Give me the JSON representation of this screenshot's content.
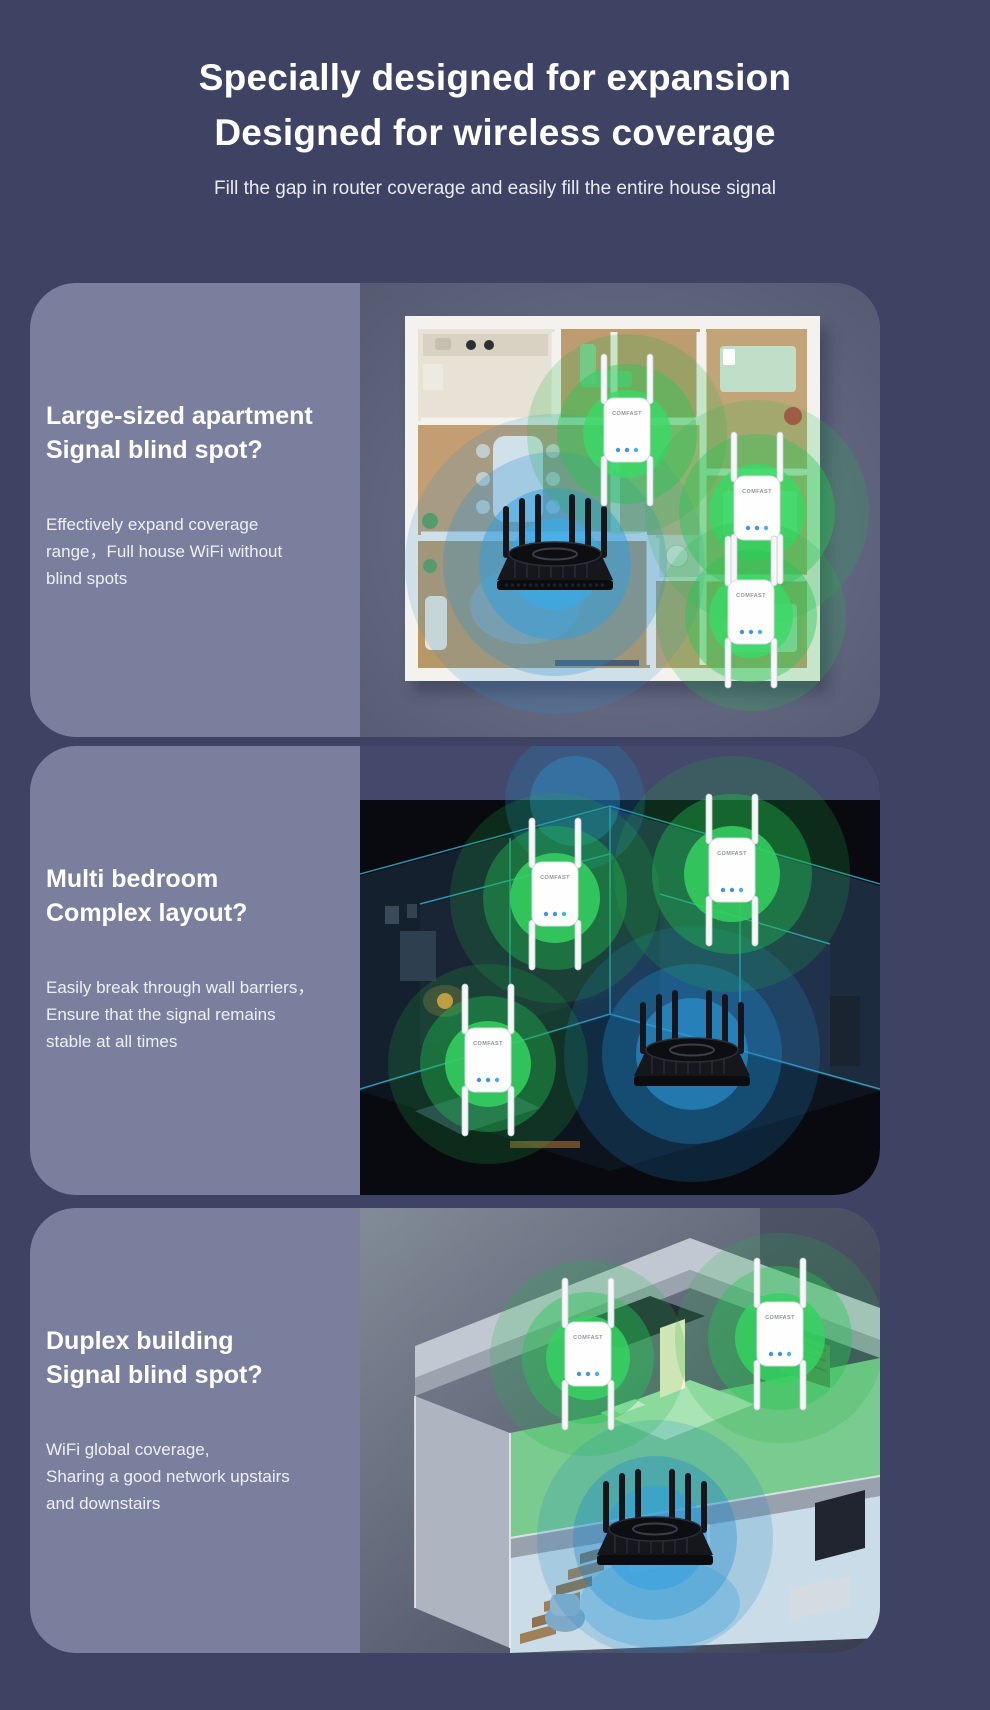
{
  "page": {
    "background_color": "#3E4263",
    "panel_color": "#7A7F9E"
  },
  "header": {
    "title_line1": "Specially designed for expansion",
    "title_line2": "Designed for wireless coverage",
    "subtitle": "Fill the gap in router coverage and easily fill the entire house signal"
  },
  "device": {
    "brand": "COMFAST"
  },
  "colors": {
    "signal_green": "#36D161",
    "signal_blue": "#2F9EDE",
    "router_body": "#15171D",
    "extender_body": "#FFFFFF",
    "title_text": "#FFFFFF",
    "body_text": "#EEF0F7"
  },
  "cards": [
    {
      "id": "large-apartment",
      "title_line1": "Large-sized apartment",
      "title_line2": "Signal blind spot?",
      "body_lines": [
        "Effectively expand coverage",
        "range，Full house WiFi without",
        "blind spots"
      ]
    },
    {
      "id": "multi-bedroom",
      "title_line1": "Multi bedroom",
      "title_line2": "Complex layout?",
      "body_lines": [
        "Easily break through wall barriers，",
        "Ensure that the signal remains",
        "stable at all times"
      ]
    },
    {
      "id": "duplex-building",
      "title_line1": "Duplex building",
      "title_line2": "Signal blind spot?",
      "body_lines": [
        "WiFi global coverage,",
        "Sharing a good network upstairs",
        "and downstairs"
      ]
    }
  ]
}
